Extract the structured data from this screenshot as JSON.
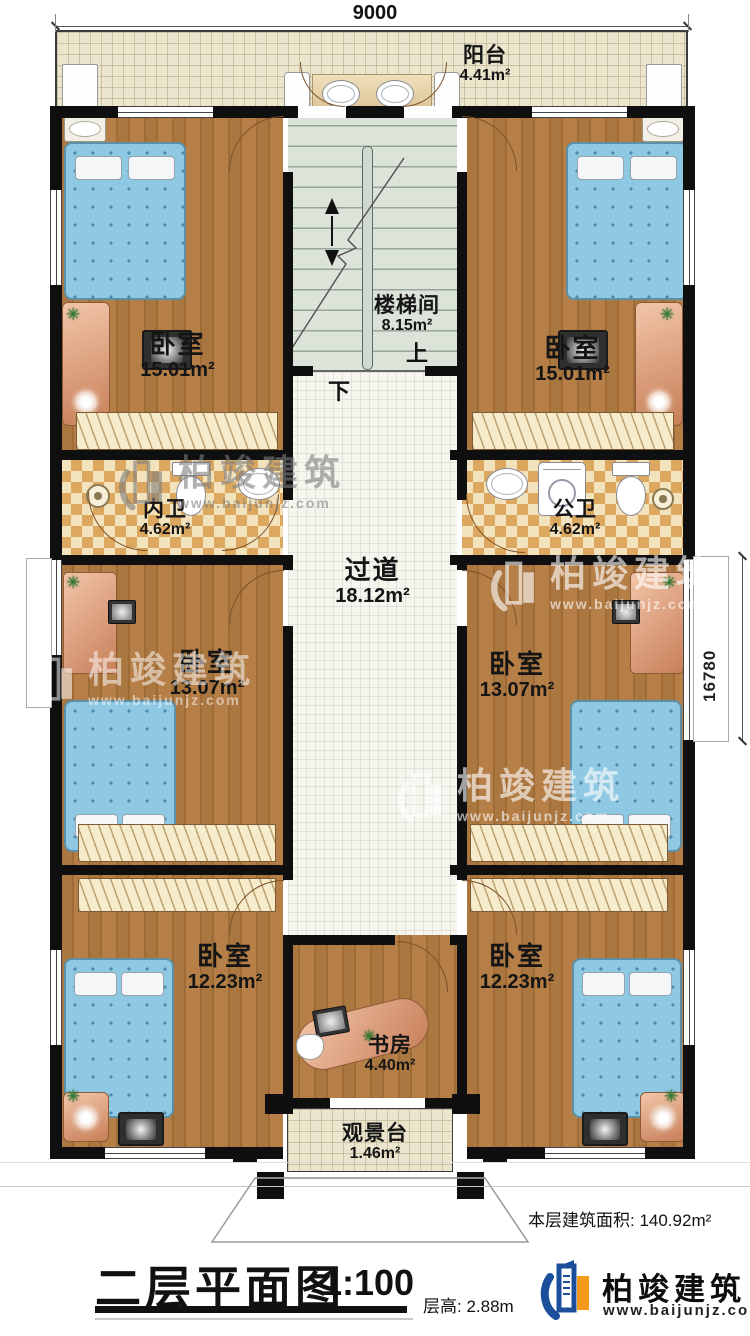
{
  "dimensions": {
    "top": "9000",
    "right": "16780"
  },
  "rooms": [
    {
      "id": "balcony",
      "name": "阳台",
      "area": "4.41m²"
    },
    {
      "id": "stairwell",
      "name": "楼梯间",
      "area": "8.15m²"
    },
    {
      "id": "bedroom_tl",
      "name": "卧室",
      "area": "15.01m²"
    },
    {
      "id": "bedroom_tr",
      "name": "卧室",
      "area": "15.01m²"
    },
    {
      "id": "bath_left",
      "name": "内卫",
      "area": "4.62m²"
    },
    {
      "id": "bath_right",
      "name": "公卫",
      "area": "4.62m²"
    },
    {
      "id": "corridor",
      "name": "过道",
      "area": "18.12m²"
    },
    {
      "id": "bedroom_ml",
      "name": "卧室",
      "area": "13.07m²"
    },
    {
      "id": "bedroom_mr",
      "name": "卧室",
      "area": "13.07m²"
    },
    {
      "id": "bedroom_bl",
      "name": "卧室",
      "area": "12.23m²"
    },
    {
      "id": "bedroom_br",
      "name": "卧室",
      "area": "12.23m²"
    },
    {
      "id": "study",
      "name": "书房",
      "area": "4.40m²"
    },
    {
      "id": "view_deck",
      "name": "观景台",
      "area": "1.46m²"
    }
  ],
  "stair": {
    "up": "上",
    "down": "下"
  },
  "summary": {
    "floor_area": "本层建筑面积: 140.92m²"
  },
  "titleblock": {
    "title": "二层平面图",
    "scale": "1:100",
    "floor_height": "层高: 2.88m"
  },
  "brand": {
    "name": "柏竣建筑",
    "url": "www.baijunjz.com"
  },
  "watermark": {
    "name": "柏竣建筑",
    "url": "www.baijunjz.com"
  },
  "icons": {
    "plant": "✳"
  },
  "colors": {
    "wall": "#0f0f0f",
    "wood": "#ab7740",
    "balcony_tile": "#eae5cc",
    "bath_tile": "#dca75f",
    "corridor_tile": "#f6f5ee",
    "stair": "#dce3d9",
    "bed": "#8fc8e2",
    "furniture": "#d89a77",
    "brand_blue": "#1b4f9c",
    "brand_orange": "#f59a1b"
  }
}
